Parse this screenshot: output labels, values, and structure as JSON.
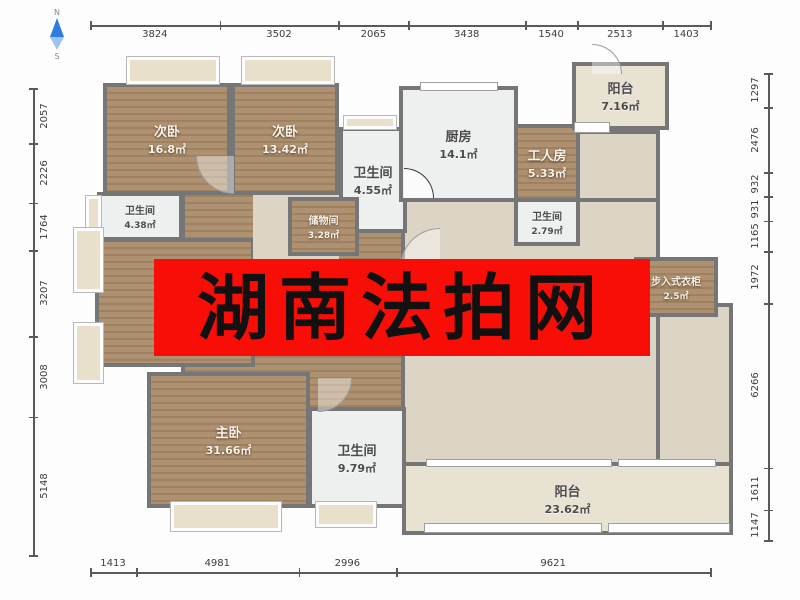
{
  "watermark": {
    "text": "湖南法拍网",
    "background": "#f90d07",
    "text_color": "#111111"
  },
  "compass": {
    "north_label": "N",
    "south_label": "S",
    "arrow_color": "#2e7ce2"
  },
  "rulers": {
    "top": [
      "3824",
      "3502",
      "2065",
      "3438",
      "1540",
      "2513",
      "1403"
    ],
    "bottom": [
      "1413",
      "4981",
      "2996",
      "9621"
    ],
    "left": [
      "2057",
      "2226",
      "1764",
      "3207",
      "3008",
      "5148"
    ],
    "right": [
      "1297",
      "2476",
      "932",
      "931",
      "1165",
      "1972",
      "6266",
      "1611",
      "1147"
    ]
  },
  "rooms": [
    {
      "id": "bedroom-top-left",
      "name": "次卧",
      "area": "16.8㎡"
    },
    {
      "id": "bedroom-top-mid",
      "name": "次卧",
      "area": "13.42㎡"
    },
    {
      "id": "bath-mid-top",
      "name": "卫生间",
      "area": "4.55㎡"
    },
    {
      "id": "kitchen",
      "name": "厨房",
      "area": "14.1㎡"
    },
    {
      "id": "worker-room",
      "name": "工人房",
      "area": "5.33㎡"
    },
    {
      "id": "balcony-top",
      "name": "阳台",
      "area": "7.16㎡"
    },
    {
      "id": "bath-right",
      "name": "卫生间",
      "area": "2.79㎡"
    },
    {
      "id": "bath-left",
      "name": "卫生间",
      "area": "4.38㎡"
    },
    {
      "id": "storage",
      "name": "储物间",
      "area": "3.28㎡"
    },
    {
      "id": "walk-in-closet",
      "name": "步入式衣柜",
      "area": "2.5㎡"
    },
    {
      "id": "master-bedroom",
      "name": "主卧",
      "area": "31.66㎡"
    },
    {
      "id": "bath-master",
      "name": "卫生间",
      "area": "9.79㎡"
    },
    {
      "id": "balcony-bottom",
      "name": "阳台",
      "area": "23.62㎡"
    }
  ]
}
